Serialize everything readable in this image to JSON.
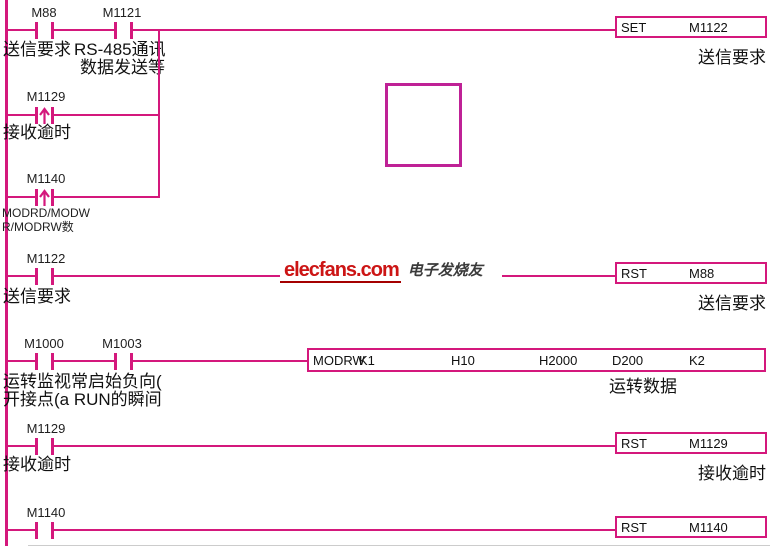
{
  "colors": {
    "line": "#d4187c",
    "empty_box": "#bf2196",
    "logo_red": "#cc1515",
    "text": "#111111"
  },
  "watermark": {
    "logo": "elecfans.com",
    "cn": "电子发烧友"
  },
  "rung1": {
    "contact1": {
      "name": "M88",
      "desc": "送信要求"
    },
    "contact2": {
      "name": "M1121",
      "desc1": "RS-485通讯",
      "desc2": "数据发送等"
    },
    "branch1": {
      "name": "M1129",
      "desc": "接收逾时"
    },
    "branch2": {
      "name": "M1140",
      "desc1": "MODRD/MODW",
      "desc2": "R/MODRW数"
    },
    "coil": {
      "op": "SET",
      "operand": "M1122",
      "desc": "送信要求"
    }
  },
  "rung2": {
    "contact": {
      "name": "M1122",
      "desc": "送信要求"
    },
    "coil": {
      "op": "RST",
      "operand": "M88",
      "desc": "送信要求"
    }
  },
  "rung3": {
    "contact1": {
      "name": "M1000"
    },
    "contact2": {
      "name": "M1003"
    },
    "desc1": "运转监视常启始负向(",
    "desc2": "开接点(a RUN的瞬间",
    "instr": {
      "op": "MODRW",
      "args": [
        "K1",
        "H10",
        "H2000",
        "D200",
        "K2"
      ],
      "desc": "运转数据"
    }
  },
  "rung4": {
    "contact": {
      "name": "M1129",
      "desc": "接收逾时"
    },
    "coil": {
      "op": "RST",
      "operand": "M1129",
      "desc": "接收逾时"
    }
  },
  "rung5": {
    "contact": {
      "name": "M1140"
    },
    "coil": {
      "op": "RST",
      "operand": "M1140"
    }
  }
}
